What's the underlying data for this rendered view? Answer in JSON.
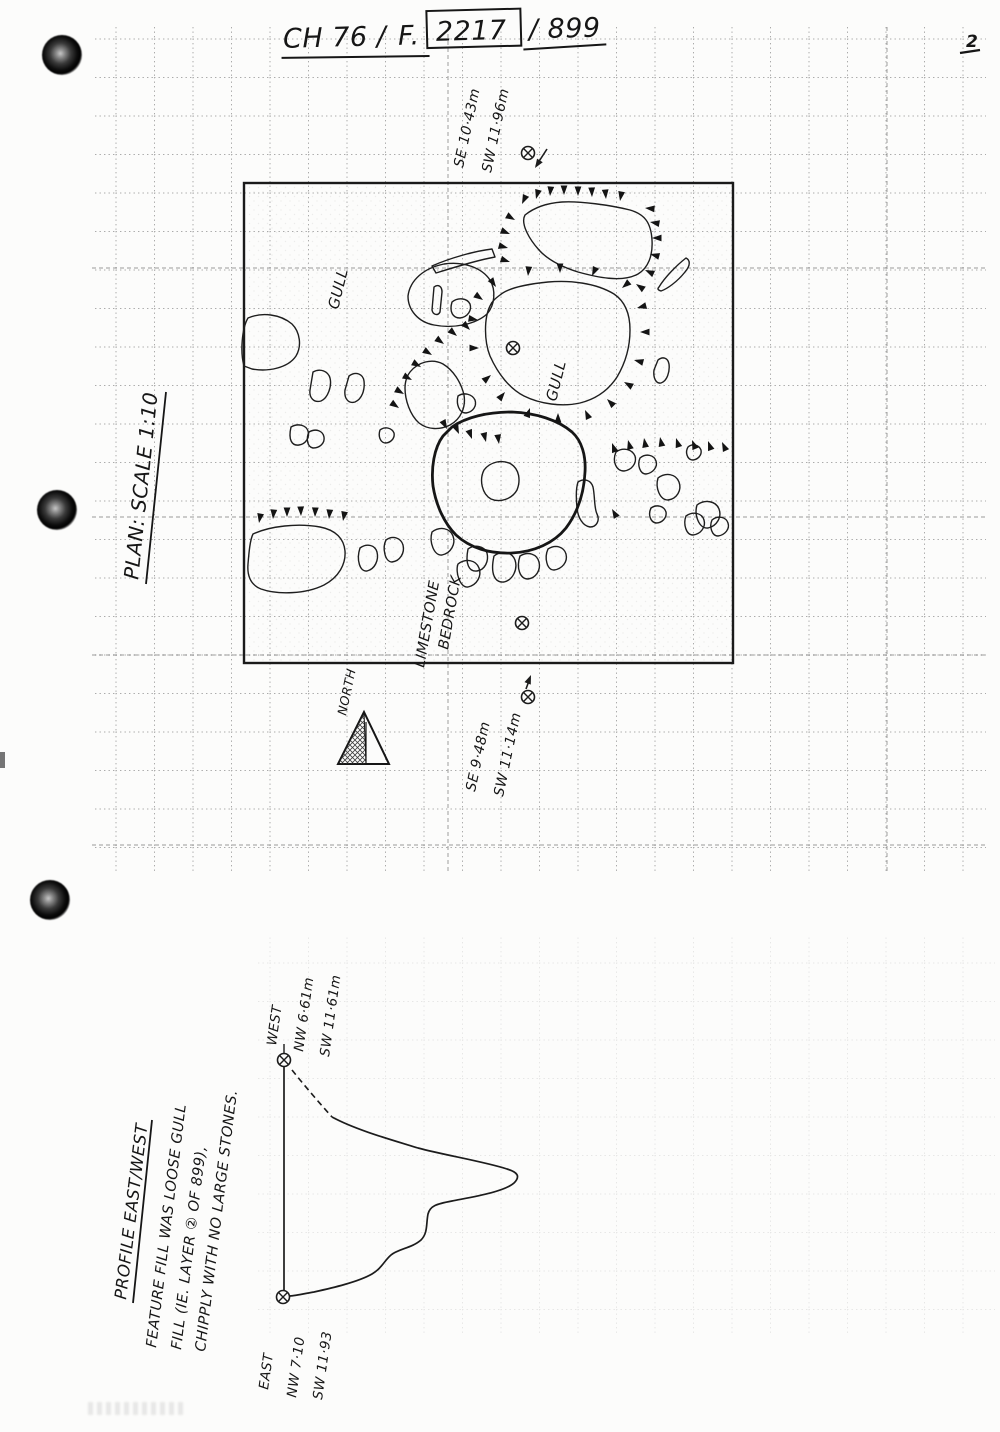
{
  "header": {
    "site_code": "CH 76 /",
    "feature_label": "F.",
    "feature_number": "2217",
    "context": "/ 899",
    "page_number": "2"
  },
  "plan": {
    "caption": "PLAN: SCALE 1:10",
    "north_label": "NORTH",
    "labels": {
      "gull_upper": "GULL",
      "gull_main": "GULL",
      "limestone_line1": "LIMESTONE",
      "limestone_line2": "BEDROCK"
    },
    "levels": {
      "point_a": {
        "line1": "SE 10·43m",
        "line2": "SW 11·96m"
      },
      "point_b": {
        "line1": "SE 9·48m",
        "line2": "SW 11·14m"
      }
    }
  },
  "profile": {
    "heading": "PROFILE EAST/WEST",
    "notes": {
      "line1": "FEATURE FILL WAS LOOSE GULL",
      "line2": "FILL (IE. LAYER ② OF 899),",
      "line3": "CHIPPLY WITH NO LARGE STONES."
    },
    "west_point": {
      "label": "WEST",
      "line1": "NW 6·61m",
      "line2": "SW 11·61m"
    },
    "east_point": {
      "label": "EAST",
      "line1": "NW 7·10",
      "line2": "SW 11·93"
    }
  }
}
